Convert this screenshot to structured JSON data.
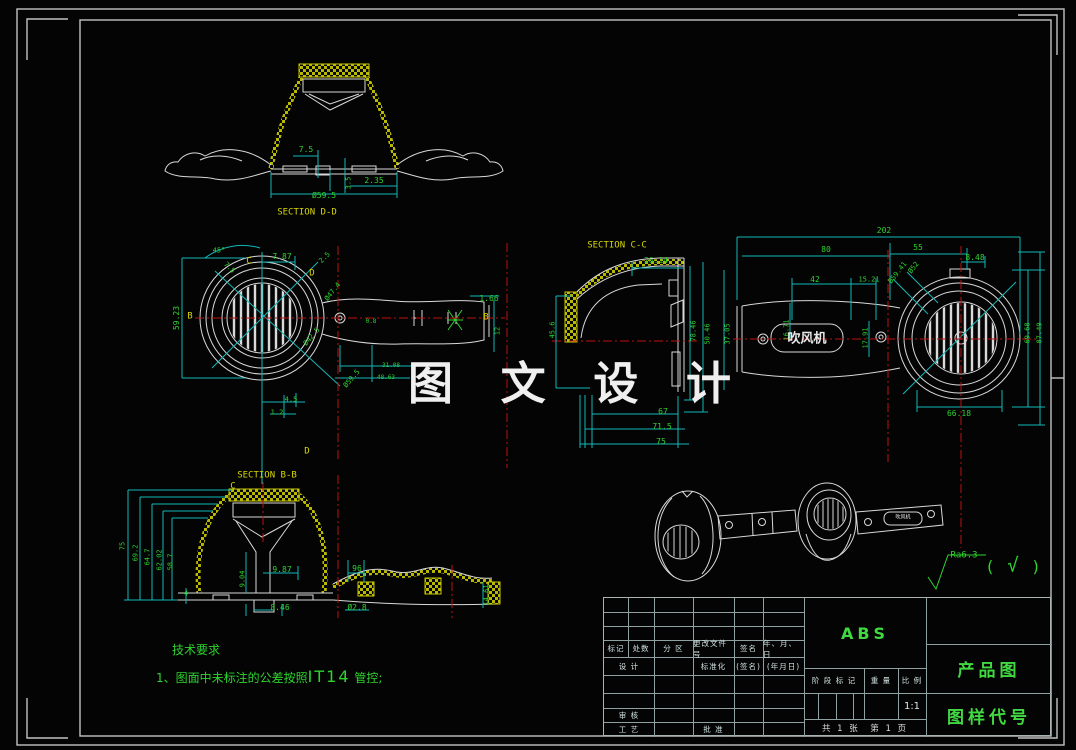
{
  "colors": {
    "g": "#2ed32e",
    "c": "#12b8b8",
    "y": "#d6d600",
    "w": "#e8e8e8",
    "hatch": "#c9c900",
    "centerline": "#bb1111",
    "title_green": "#41d941"
  },
  "watermark": {
    "text": "图 文 设 计"
  },
  "tech_requirements": {
    "title": "技术要求",
    "line2_pre": "1、图面中未标注的公差按照",
    "line2_code": "IT14",
    "line2_post": " 管控;"
  },
  "title_block": {
    "material": "ABS",
    "drawing_name": "产品图",
    "drawing_code": "图样代号",
    "scale_value": "1:1",
    "headers": [
      "标记",
      "处数",
      "分 区",
      "更改文件号",
      "签名",
      "年、月、日"
    ],
    "design": "设 计",
    "standardization": "标准化",
    "sign": "(签名)",
    "date": "(年月日)",
    "review": "审 核",
    "process": "工 艺",
    "approve": "批 准",
    "stage_mark": "阶 段 标 记",
    "weight": "重 量",
    "scale_label": "比 例",
    "sheet_info": "共 1 张　第 1 页"
  },
  "annotations": [
    {
      "n": "dim",
      "t": "7.5",
      "x": 306,
      "y": 150,
      "c": "g",
      "s": 8
    },
    {
      "n": "dim",
      "t": "3.5",
      "x": 349,
      "y": 183,
      "c": "g",
      "s": 7,
      "r": -90
    },
    {
      "n": "dim",
      "t": "2.35",
      "x": 374,
      "y": 181,
      "c": "g",
      "s": 8
    },
    {
      "n": "dim",
      "t": "Ø59.5",
      "x": 324,
      "y": 196,
      "c": "g",
      "s": 8
    },
    {
      "n": "section-label-dd",
      "t": "SECTION D-D",
      "x": 307,
      "y": 213,
      "c": "y",
      "s": 9
    },
    {
      "n": "dim",
      "t": "45°",
      "x": 219,
      "y": 251,
      "c": "g",
      "s": 7
    },
    {
      "n": "dim",
      "t": "7.5",
      "x": 229,
      "y": 268,
      "c": "g",
      "s": 7,
      "r": 45
    },
    {
      "n": "dim",
      "t": "7.87",
      "x": 282,
      "y": 257,
      "c": "g",
      "s": 8
    },
    {
      "n": "cut-label",
      "t": "C",
      "x": 249,
      "y": 262,
      "c": "y",
      "s": 9
    },
    {
      "n": "dim",
      "t": "2.5",
      "x": 325,
      "y": 258,
      "c": "g",
      "s": 7,
      "r": -45
    },
    {
      "n": "cut-label",
      "t": "D",
      "x": 312,
      "y": 274,
      "c": "y",
      "s": 9
    },
    {
      "n": "dim",
      "t": "Ø47.4",
      "x": 333,
      "y": 292,
      "c": "g",
      "s": 7,
      "r": -52
    },
    {
      "n": "cut-label",
      "t": "B",
      "x": 190,
      "y": 317,
      "c": "y",
      "s": 9
    },
    {
      "n": "cut-label",
      "t": "B",
      "x": 486,
      "y": 318,
      "c": "y",
      "s": 9
    },
    {
      "n": "dim",
      "t": "59.23",
      "x": 177,
      "y": 318,
      "c": "g",
      "s": 8,
      "r": -90
    },
    {
      "n": "dim",
      "t": "Ø42.5",
      "x": 312,
      "y": 337,
      "c": "g",
      "s": 7,
      "r": -50
    },
    {
      "n": "dim",
      "t": "1.66",
      "x": 489,
      "y": 299,
      "c": "g",
      "s": 8
    },
    {
      "n": "dim",
      "t": "12",
      "x": 498,
      "y": 331,
      "c": "g",
      "s": 7,
      "r": -90
    },
    {
      "n": "dim",
      "t": "0.8",
      "x": 371,
      "y": 322,
      "c": "g",
      "s": 6
    },
    {
      "n": "dim",
      "t": "31.08",
      "x": 391,
      "y": 366,
      "c": "g",
      "s": 6
    },
    {
      "n": "dim",
      "t": "48.63",
      "x": 386,
      "y": 378,
      "c": "g",
      "s": 6
    },
    {
      "n": "dim",
      "t": "Ø59.5",
      "x": 352,
      "y": 379,
      "c": "g",
      "s": 7,
      "r": -50
    },
    {
      "n": "cut-label",
      "t": "D",
      "x": 307,
      "y": 452,
      "c": "y",
      "s": 9
    },
    {
      "n": "dim",
      "t": "4.5",
      "x": 291,
      "y": 400,
      "c": "g",
      "s": 7
    },
    {
      "n": "dim",
      "t": "1.2",
      "x": 277,
      "y": 413,
      "c": "g",
      "s": 7
    },
    {
      "n": "cut-label",
      "t": "C",
      "x": 233,
      "y": 487,
      "c": "y",
      "s": 9
    },
    {
      "n": "section-label-cc",
      "t": "SECTION C-C",
      "x": 617,
      "y": 246,
      "c": "y",
      "s": 9
    },
    {
      "n": "dim",
      "t": "26.14",
      "x": 656,
      "y": 261,
      "c": "g",
      "s": 8
    },
    {
      "n": "dim",
      "t": "45.6",
      "x": 553,
      "y": 330,
      "c": "g",
      "s": 7,
      "r": -90
    },
    {
      "n": "dim",
      "t": "78.46",
      "x": 694,
      "y": 331,
      "c": "g",
      "s": 7,
      "r": -90
    },
    {
      "n": "dim",
      "t": "50.46",
      "x": 708,
      "y": 334,
      "c": "g",
      "s": 7,
      "r": -90
    },
    {
      "n": "dim",
      "t": "37.05",
      "x": 728,
      "y": 334,
      "c": "g",
      "s": 7,
      "r": -90
    },
    {
      "n": "dim",
      "t": "67",
      "x": 663,
      "y": 412,
      "c": "g",
      "s": 8
    },
    {
      "n": "dim",
      "t": "71.5",
      "x": 662,
      "y": 427,
      "c": "g",
      "s": 8
    },
    {
      "n": "dim",
      "t": "75",
      "x": 661,
      "y": 442,
      "c": "g",
      "s": 8
    },
    {
      "n": "dim",
      "t": "202",
      "x": 884,
      "y": 231,
      "c": "g",
      "s": 8
    },
    {
      "n": "dim",
      "t": "80",
      "x": 826,
      "y": 250,
      "c": "g",
      "s": 8
    },
    {
      "n": "dim",
      "t": "55",
      "x": 918,
      "y": 248,
      "c": "g",
      "s": 8
    },
    {
      "n": "dim",
      "t": "8.48",
      "x": 975,
      "y": 258,
      "c": "g",
      "s": 8
    },
    {
      "n": "dim",
      "t": "Ø59.41",
      "x": 898,
      "y": 273,
      "c": "g",
      "s": 7,
      "r": -52
    },
    {
      "n": "dim",
      "t": "Ø52",
      "x": 914,
      "y": 268,
      "c": "g",
      "s": 7,
      "r": -52
    },
    {
      "n": "dim",
      "t": "42",
      "x": 815,
      "y": 280,
      "c": "g",
      "s": 8
    },
    {
      "n": "dim",
      "t": "15.21",
      "x": 869,
      "y": 280,
      "c": "g",
      "s": 7
    },
    {
      "n": "dim",
      "t": "16.71",
      "x": 787,
      "y": 330,
      "c": "g",
      "s": 7,
      "r": -90
    },
    {
      "n": "dim",
      "t": "17.91",
      "x": 866,
      "y": 338,
      "c": "g",
      "s": 7,
      "r": -90
    },
    {
      "n": "dim",
      "t": "69.68",
      "x": 1028,
      "y": 333,
      "c": "g",
      "s": 7,
      "r": -90
    },
    {
      "n": "dim",
      "t": "87.49",
      "x": 1040,
      "y": 333,
      "c": "g",
      "s": 7,
      "r": -90
    },
    {
      "n": "dim",
      "t": "66.18",
      "x": 959,
      "y": 414,
      "c": "g",
      "s": 8
    },
    {
      "n": "product-label",
      "t": "吹风机",
      "x": 807,
      "y": 339,
      "c": "w",
      "s": 13,
      "b": 1
    },
    {
      "n": "section-label-bb",
      "t": "SECTION B-B",
      "x": 267,
      "y": 476,
      "c": "y",
      "s": 9
    },
    {
      "n": "dim",
      "t": "75",
      "x": 123,
      "y": 546,
      "c": "g",
      "s": 7,
      "r": -90
    },
    {
      "n": "dim",
      "t": "69.2",
      "x": 136,
      "y": 553,
      "c": "g",
      "s": 7,
      "r": -90
    },
    {
      "n": "dim",
      "t": "64.7",
      "x": 148,
      "y": 557,
      "c": "g",
      "s": 7,
      "r": -90
    },
    {
      "n": "dim",
      "t": "62.02",
      "x": 160,
      "y": 560,
      "c": "g",
      "s": 7,
      "r": -90
    },
    {
      "n": "dim",
      "t": "58.7",
      "x": 171,
      "y": 562,
      "c": "g",
      "s": 7,
      "r": -90
    },
    {
      "n": "dim",
      "t": "4",
      "x": 186,
      "y": 594,
      "c": "g",
      "s": 7
    },
    {
      "n": "dim",
      "t": "9.04",
      "x": 243,
      "y": 579,
      "c": "g",
      "s": 7,
      "r": -90
    },
    {
      "n": "dim",
      "t": "9.87",
      "x": 282,
      "y": 570,
      "c": "g",
      "s": 8
    },
    {
      "n": "dim",
      "t": "8.46",
      "x": 280,
      "y": 608,
      "c": "g",
      "s": 8
    },
    {
      "n": "dim",
      "t": "96",
      "x": 357,
      "y": 569,
      "c": "g",
      "s": 8
    },
    {
      "n": "dim",
      "t": "Ø2.8",
      "x": 357,
      "y": 608,
      "c": "g",
      "s": 8
    },
    {
      "n": "dim",
      "t": "14.61",
      "x": 487,
      "y": 595,
      "c": "g",
      "s": 7,
      "r": -90
    },
    {
      "n": "product-label-small",
      "t": "吹风机",
      "x": 903,
      "y": 518,
      "c": "w",
      "s": 5
    },
    {
      "n": "surface-finish-ra",
      "t": "Ra6.3",
      "x": 964,
      "y": 556,
      "c": "g",
      "s": 9
    },
    {
      "n": "surface-finish-paren-open",
      "t": "(",
      "x": 990,
      "y": 567,
      "c": "g",
      "s": 16
    },
    {
      "n": "surface-finish-check",
      "t": "√",
      "x": 1013,
      "y": 566,
      "c": "g",
      "s": 19
    },
    {
      "n": "surface-finish-paren-close",
      "t": ")",
      "x": 1036,
      "y": 567,
      "c": "g",
      "s": 16
    }
  ]
}
